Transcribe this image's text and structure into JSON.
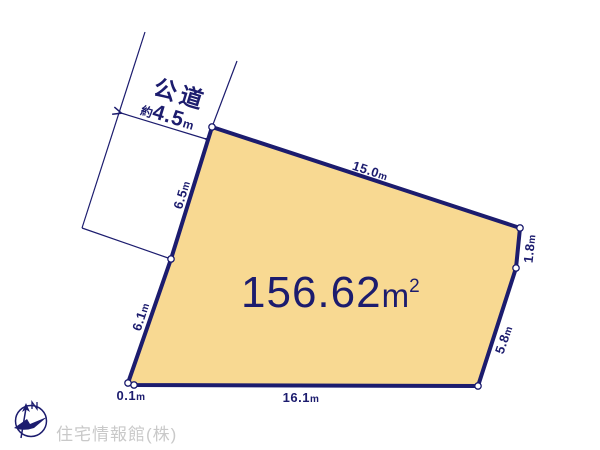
{
  "colors": {
    "line_and_text": "#1C1C6E",
    "plot_fill": "#F8D992",
    "watermark_text": "#C9C9C9",
    "background": "#FFFFFF"
  },
  "road": {
    "name": "公道",
    "width_prefix": "約",
    "width_value": "4.5",
    "width_unit": "m"
  },
  "plot": {
    "area_value": "156.62",
    "area_unit": "m",
    "area_exponent": "2"
  },
  "edges": {
    "top": {
      "value": "15.0",
      "unit": "m"
    },
    "right_upper": {
      "value": "1.8",
      "unit": "m"
    },
    "right_lower": {
      "value": "5.8",
      "unit": "m"
    },
    "bottom": {
      "value": "16.1",
      "unit": "m"
    },
    "bottom_left": {
      "value": "0.1",
      "unit": "m"
    },
    "left_lower": {
      "value": "6.1",
      "unit": "m"
    },
    "left_upper": {
      "value": "6.5",
      "unit": "m"
    }
  },
  "footer": {
    "company": "住宅情報館(株)"
  }
}
